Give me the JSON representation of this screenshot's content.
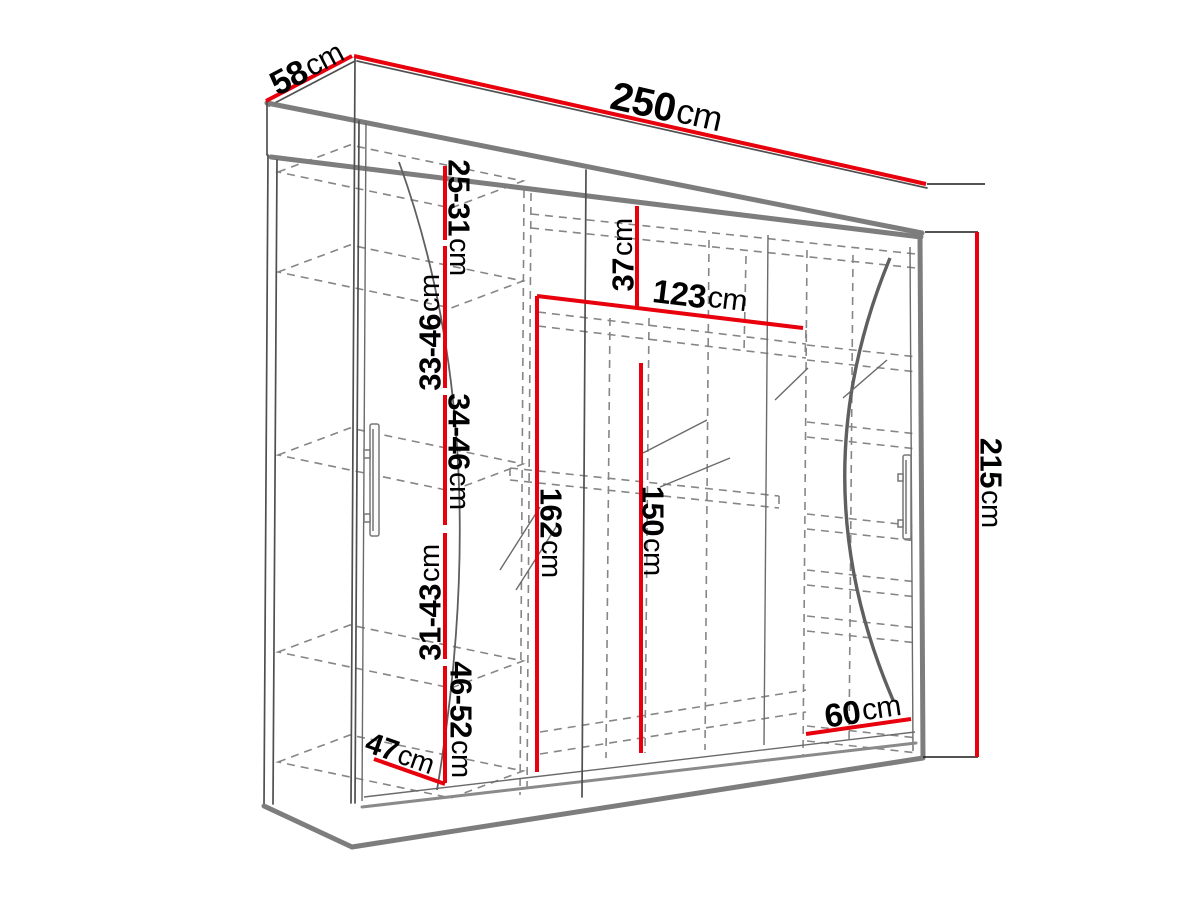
{
  "diagram": {
    "title": "wardrobe-dimension-diagram",
    "colors": {
      "dimension_line": "#e8000d",
      "structure_line": "#7d7d7d",
      "dashed_line": "#868686",
      "text": "#000000",
      "background": "#ffffff"
    },
    "dimensions": {
      "depth_top": {
        "value": "58",
        "unit": "cm"
      },
      "width_top": {
        "value": "250",
        "unit": "cm"
      },
      "height_right": {
        "value": "215",
        "unit": "cm"
      },
      "gap_1": {
        "value": "25-31",
        "unit": "cm"
      },
      "gap_2": {
        "value": "33-46",
        "unit": "cm"
      },
      "gap_3": {
        "value": "34-46",
        "unit": "cm"
      },
      "gap_4": {
        "value": "31-43",
        "unit": "cm"
      },
      "gap_5": {
        "value": "46-52",
        "unit": "cm"
      },
      "top_shelf_height": {
        "value": "37",
        "unit": "cm"
      },
      "middle_shelf_width": {
        "value": "123",
        "unit": "cm"
      },
      "left_interior_height": {
        "value": "162",
        "unit": "cm"
      },
      "hanging_height": {
        "value": "150",
        "unit": "cm"
      },
      "right_shelf_width": {
        "value": "60",
        "unit": "cm"
      },
      "bottom_shelf_depth": {
        "value": "47",
        "unit": "cm"
      }
    }
  }
}
